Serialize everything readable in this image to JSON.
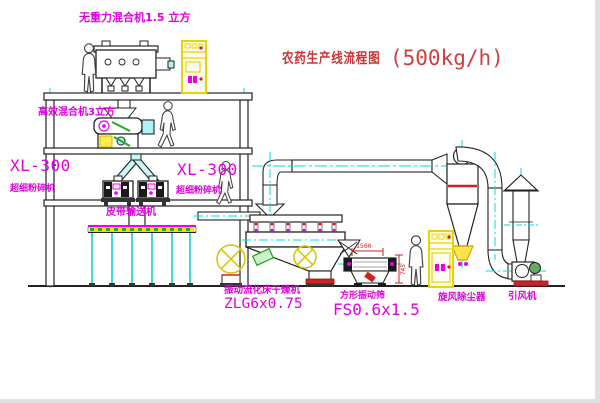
{
  "drawing": {
    "title": {
      "name": "农药生产线流程图",
      "capacity": "(500kg/h)"
    },
    "equipment_labels": {
      "gravity_mixer": "无重力混合机1.5 立方",
      "high_efficiency_mixer": "高效混合机3立方",
      "pulverizer_left": {
        "model": "XL-300",
        "name": "超细粉碎机"
      },
      "pulverizer_center": {
        "model": "XL-300",
        "name": "超细粉碎机"
      },
      "belt_conveyor": "皮带输送机",
      "fluid_bed_dryer": {
        "name": "振动流化床干燥机",
        "model": "ZLG6x0.75"
      },
      "square_sieve": {
        "name": "方形振动筛",
        "model": "FS0.6x1.5"
      },
      "cyclone": "旋风除尘器",
      "induced_draft_fan": "引风机"
    },
    "dimensions": {
      "sieve_length": "1500",
      "sieve_height": "745"
    },
    "colors": {
      "label_magenta": "#e100e1",
      "title_red": "#c93434",
      "cad_cyan": "#00dcdc",
      "cad_yellow": "#e8d400",
      "dimension_red": "#cc2222",
      "line_dark": "#1c1c1c"
    }
  }
}
